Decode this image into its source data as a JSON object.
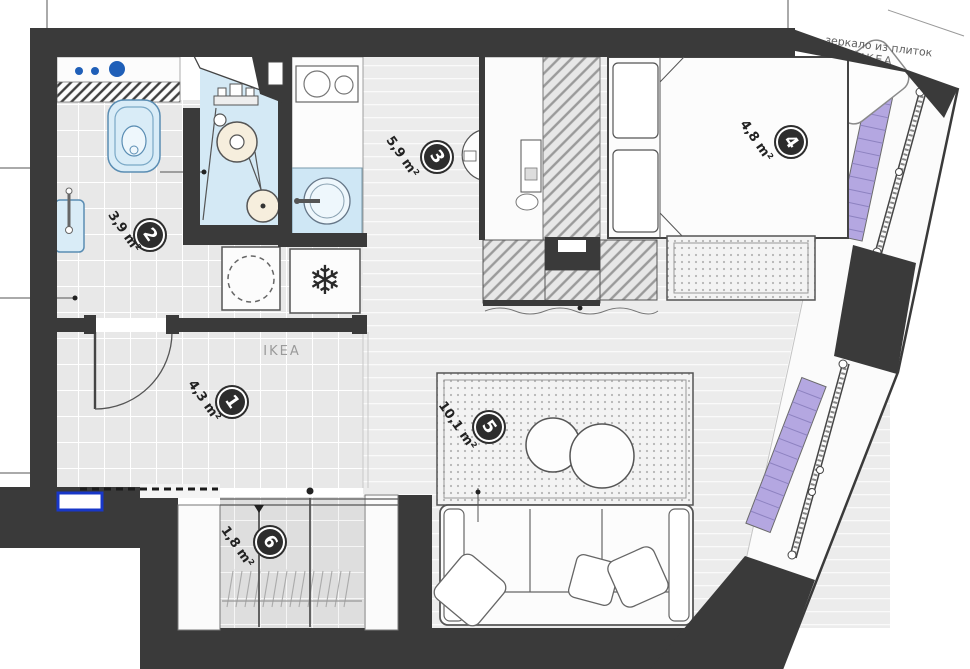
{
  "plan": {
    "rooms": [
      {
        "number": "1",
        "area": "4,3 m²"
      },
      {
        "number": "2",
        "area": "3,9 m²"
      },
      {
        "number": "3",
        "area": "5,9 m²"
      },
      {
        "number": "4",
        "area": "4,8 m²"
      },
      {
        "number": "5",
        "area": "10,1 m²"
      },
      {
        "number": "6",
        "area": "1,8 m²"
      }
    ],
    "hall_brand_label": "IKEA",
    "annotation": {
      "line1": "зеркало из плиток",
      "line2": "IKEA"
    },
    "icons": {
      "freezer": "❄"
    },
    "colors": {
      "wall": "#3a3a3a",
      "fixture_blue": "#d4e9f5",
      "accent_blue": "#1f5fb8",
      "radiator_purple": "#b4a7e1",
      "doormat_blue": "#1837c8"
    }
  }
}
